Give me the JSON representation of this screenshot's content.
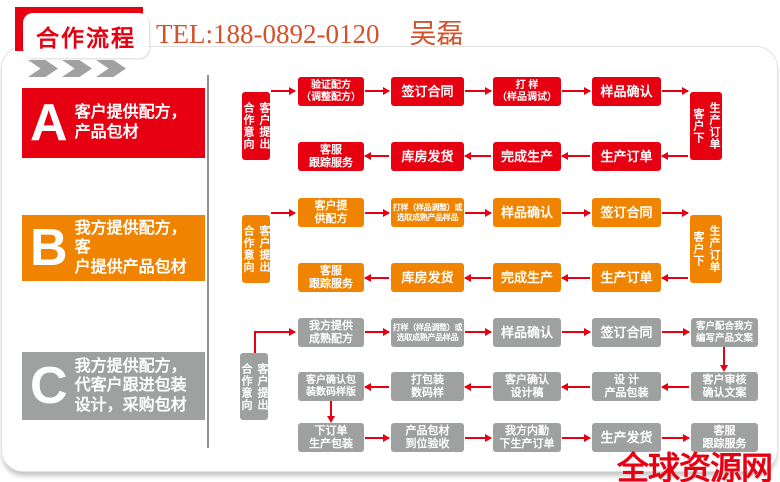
{
  "header": {
    "tab_label": "合作流程",
    "tel": "TEL:188-0892-0120",
    "contact_name": "吴磊"
  },
  "colors": {
    "red": "#e60012",
    "orange": "#f08300",
    "gray": "#9fa0a0",
    "tel_text": "#d4512a"
  },
  "sections": [
    {
      "letter": "A",
      "label": "客户提供配方，\n产品包材"
    },
    {
      "letter": "B",
      "label": "我方提供配方，客\n户提供产品包材"
    },
    {
      "letter": "C",
      "label": "我方提供配方，\n代客户跟进包装\n设计，采购包材"
    }
  ],
  "flow_a": {
    "start": [
      "合作意向",
      "客户提出"
    ],
    "top": [
      "验证配方\n（调整配方）",
      "签订合同",
      "打 样\n（样品调试）",
      "样品确认"
    ],
    "end": [
      "客户下",
      "生产订单"
    ],
    "bottom": [
      "客服\n跟踪服务",
      "库房发货",
      "完成生产",
      "生产订单"
    ]
  },
  "flow_b": {
    "start": [
      "合作意向",
      "客户提出"
    ],
    "top": [
      "客户提\n供配方",
      "打样（样品调整）或\n选取成熟产品样品",
      "样品确认",
      "签订合同"
    ],
    "end": [
      "客户下",
      "生产订单"
    ],
    "bottom": [
      "客服\n跟踪服务",
      "库房发货",
      "完成生产",
      "生产订单"
    ]
  },
  "flow_c": {
    "start": [
      "合作意向",
      "客户提出"
    ],
    "row1": [
      "我方提供\n成熟配方",
      "打样（样品调整）或\n选取成熟产品样品",
      "样品确认",
      "签订合同",
      "客户配合我方\n编写产品文案"
    ],
    "row2": [
      "客户确认包\n装数码样版",
      "打包装\n数码样",
      "客户确认\n设计稿",
      "设 计\n产品包装",
      "客户审核\n确认文案"
    ],
    "row3": [
      "下订单\n生产包装",
      "产品包材\n到位验收",
      "我方内勤\n下生产订单",
      "生产发货",
      "客服\n跟踪服务"
    ]
  },
  "watermark": "全球资源网"
}
